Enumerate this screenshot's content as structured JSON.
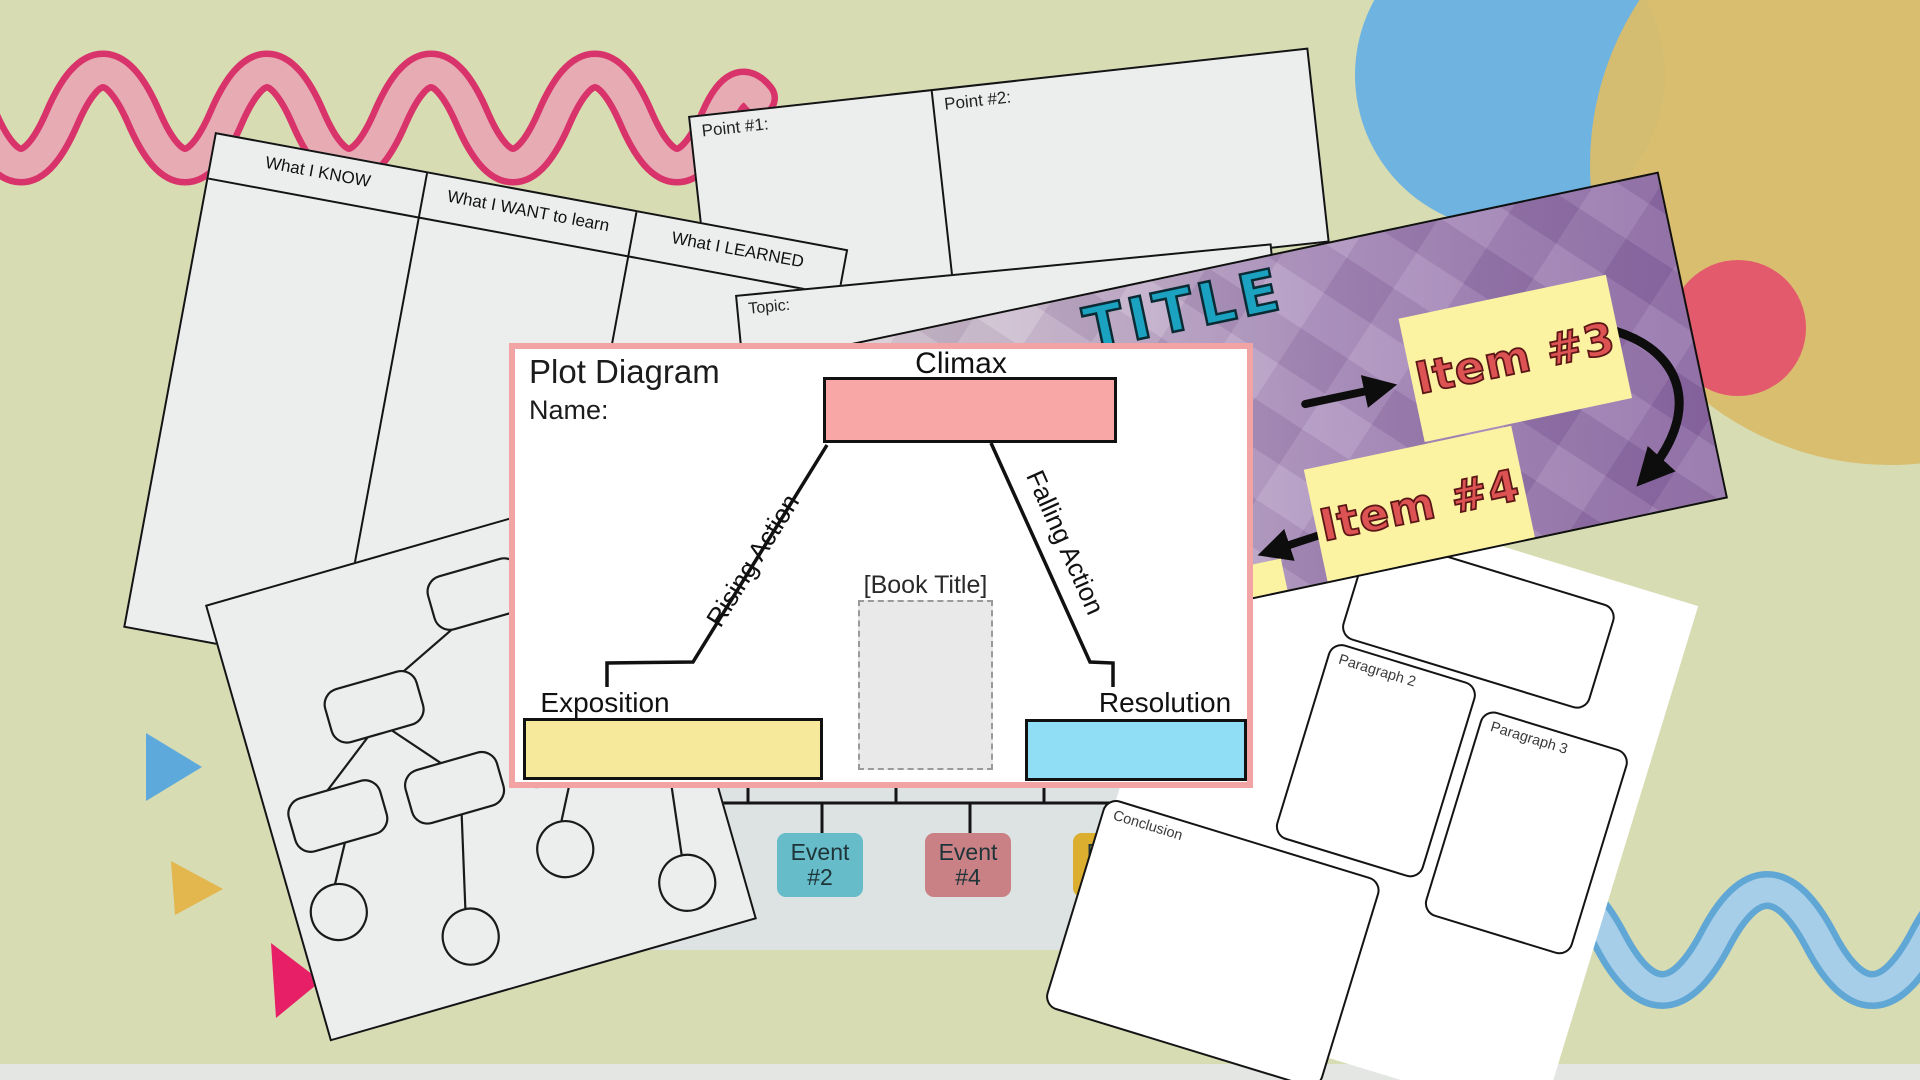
{
  "background": {
    "color": "#d7dcb3",
    "bottom_strip_color": "#e3e6e3"
  },
  "decor": {
    "pink_squiggle": {
      "stroke": "#d8336a",
      "fill": "#e7abb4"
    },
    "blue_squiggle": {
      "stroke": "#61a7d6",
      "fill": "#a7cee8"
    },
    "blue_circle": "#6fb3e1",
    "tan_circle": "#d8bc6c",
    "red_circle": "#e25a6c",
    "blue_triangle": "#5ea9dc",
    "yellow_triangle": "#e3b64e",
    "pink_triangle": "#e71f66"
  },
  "kwl": {
    "headers": [
      "What I KNOW",
      "What I WANT to learn",
      "What I LEARNED"
    ]
  },
  "points": {
    "point1": "Point #1:",
    "point2": "Point #2:",
    "topic": "Topic:"
  },
  "banner": {
    "title": "TITLE",
    "title_color": "#1aa2c0",
    "item_bg": "#fbf3a2",
    "item_text_color": "#dd5353",
    "items": [
      {
        "label": "Item #3"
      },
      {
        "label": "Item #4"
      }
    ]
  },
  "plot": {
    "title": "Plot Diagram",
    "name_label": "Name:",
    "climax": "Climax",
    "rising": "Rising Action",
    "falling": "Falling Action",
    "exposition": "Exposition",
    "resolution": "Resolution",
    "book_title": "[Book Title]",
    "border_color": "#f2a3a3",
    "climax_fill": "#f9a6a6",
    "exposition_fill": "#f7e99b",
    "resolution_fill": "#90def5",
    "book_box_fill": "#e9e9e9"
  },
  "timeline": {
    "panel_color": "#dde2e3",
    "events": [
      {
        "line1": "Event",
        "line2": "#2",
        "color": "#66bcc9"
      },
      {
        "line1": "Event",
        "line2": "#4",
        "color": "#ca8186"
      },
      {
        "line1": "Event",
        "line2": "#",
        "color": "#dcae2f"
      }
    ]
  },
  "paragraphs": {
    "p2": "Paragraph 2",
    "p3": "Paragraph 3",
    "conclusion": "Conclusion"
  }
}
